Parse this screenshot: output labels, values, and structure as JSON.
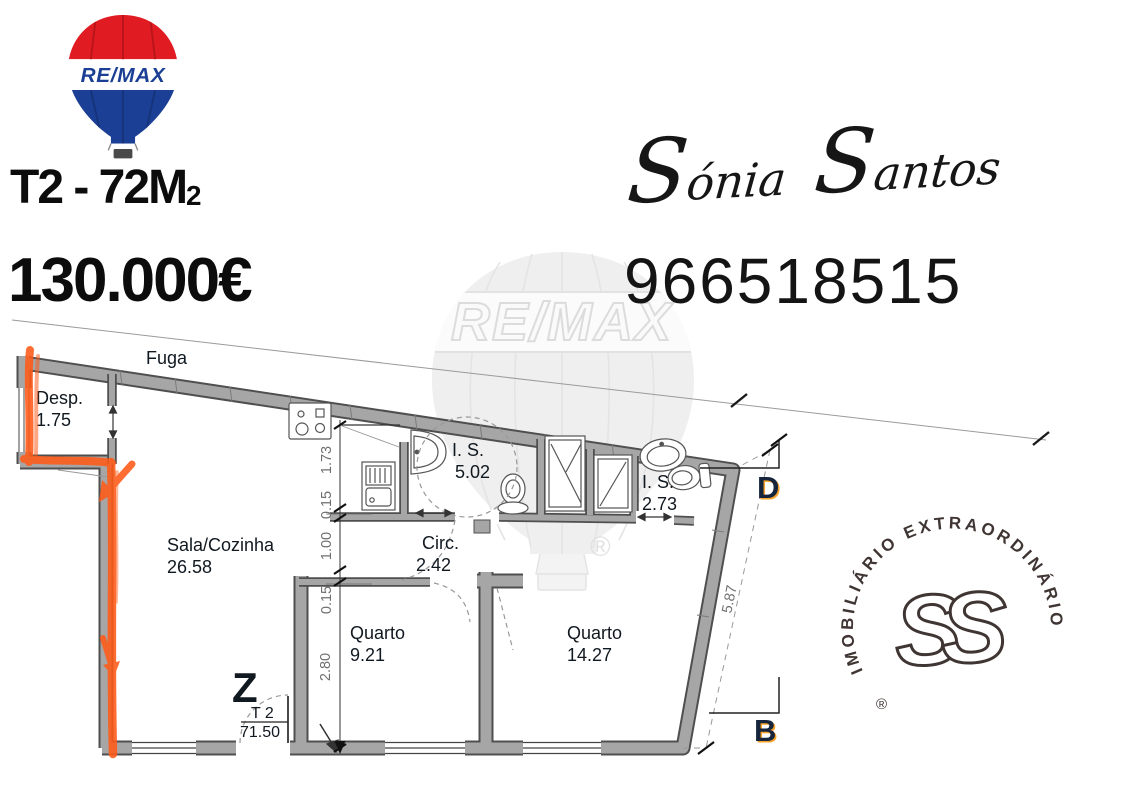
{
  "poster": {
    "logo": {
      "brand": "RE/MAX"
    },
    "listing": {
      "title_main": "T2 - 72M",
      "title_sub": "2",
      "price": "130.000€"
    },
    "agent": {
      "first_name": "Sónia",
      "last_name": "Santos",
      "phone": "966518515"
    }
  },
  "floor_plan": {
    "outside_label": "Fuga",
    "rooms": {
      "desp": {
        "label": "Desp.",
        "area": "1.75"
      },
      "sala": {
        "label": "Sala/Cozinha",
        "area": "26.58"
      },
      "is_large": {
        "label": "I. S.",
        "area": "5.02"
      },
      "is_small": {
        "label": "I. S.",
        "area": "2.73"
      },
      "circ": {
        "label": "Circ.",
        "area": "2.42"
      },
      "quarto1": {
        "label": "Quarto",
        "area": "9.21"
      },
      "quarto2": {
        "label": "Quarto",
        "area": "14.27"
      }
    },
    "totals": {
      "type_label": "T 2",
      "area": "71.50"
    },
    "markers": {
      "entrance": "Z",
      "section_d": "D",
      "section_b": "B"
    },
    "dimensions": {
      "kitchen": "1.73",
      "wall1": "0.15",
      "pass": "1.00",
      "wall2": "0.15",
      "quarto1_depth": "2.80",
      "right_wall": "5.87"
    }
  },
  "stamp": {
    "ring_text": "IMOBILIÁRIO EXTRAORDINÁRIO",
    "registered": "®",
    "monogram_left": "S",
    "monogram_right": "S"
  },
  "watermark": {
    "brand": "RE/MAX",
    "registered": "®"
  },
  "colors": {
    "remax_red": "#e11b22",
    "remax_blue": "#1b3f94",
    "marker_orange": "#ff5a17",
    "wall_gray": "#a6a6a6",
    "label_ink": "#101820",
    "stamp_ink": "#352b28"
  }
}
